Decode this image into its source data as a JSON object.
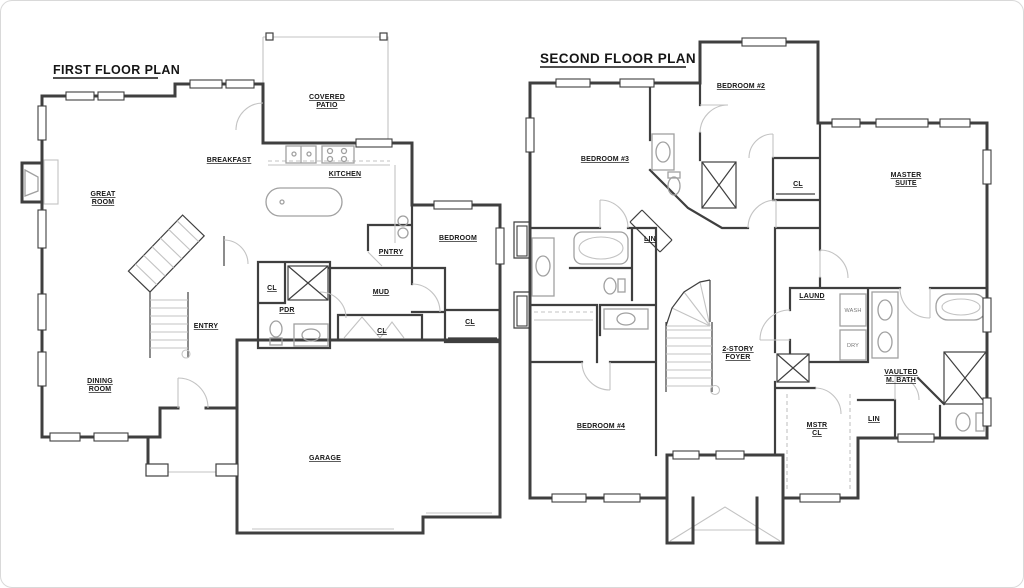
{
  "document": {
    "kind": "residential floor plan drawing"
  },
  "colors": {
    "background": "#ffffff",
    "wall": "#3f3f3f",
    "fixture": "#a0a0a0",
    "light": "#c3c3c3",
    "label": "#161616"
  },
  "first_floor": {
    "title": "FIRST FLOOR PLAN",
    "rooms": [
      {
        "name": "room-label-great-room",
        "lines": [
          "GREAT",
          "ROOM"
        ],
        "x": 103,
        "y": 196
      },
      {
        "name": "room-label-breakfast",
        "lines": [
          "BREAKFAST"
        ],
        "x": 229,
        "y": 162
      },
      {
        "name": "room-label-covered-patio",
        "lines": [
          "COVERED",
          "PATIO"
        ],
        "x": 327,
        "y": 99
      },
      {
        "name": "room-label-kitchen",
        "lines": [
          "KITCHEN"
        ],
        "x": 345,
        "y": 176
      },
      {
        "name": "room-label-pantry",
        "lines": [
          "PNTRY"
        ],
        "x": 391,
        "y": 254
      },
      {
        "name": "room-label-bedroom",
        "lines": [
          "BEDROOM"
        ],
        "x": 458,
        "y": 240
      },
      {
        "name": "room-label-entry",
        "lines": [
          "ENTRY"
        ],
        "x": 206,
        "y": 328
      },
      {
        "name": "room-label-mud",
        "lines": [
          "MUD"
        ],
        "x": 381,
        "y": 294
      },
      {
        "name": "room-label-powder-room",
        "lines": [
          "PDR"
        ],
        "x": 287,
        "y": 312
      },
      {
        "name": "room-label-closet-hall",
        "lines": [
          "CL"
        ],
        "x": 272,
        "y": 290
      },
      {
        "name": "room-label-closet-mud",
        "lines": [
          "CL"
        ],
        "x": 382,
        "y": 333
      },
      {
        "name": "room-label-closet-bedroom",
        "lines": [
          "CL"
        ],
        "x": 470,
        "y": 324
      },
      {
        "name": "room-label-dining-room",
        "lines": [
          "DINING",
          "ROOM"
        ],
        "x": 100,
        "y": 383
      },
      {
        "name": "room-label-garage",
        "lines": [
          "GARAGE"
        ],
        "x": 325,
        "y": 460
      }
    ]
  },
  "second_floor": {
    "title": "SECOND FLOOR PLAN",
    "rooms": [
      {
        "name": "room-label-bedroom-3",
        "lines": [
          "BEDROOM #3"
        ],
        "x": 605,
        "y": 161
      },
      {
        "name": "room-label-bedroom-2",
        "lines": [
          "BEDROOM #2"
        ],
        "x": 741,
        "y": 88
      },
      {
        "name": "room-label-master-suite",
        "lines": [
          "MASTER",
          "SUITE"
        ],
        "x": 906,
        "y": 177
      },
      {
        "name": "room-label-closet-bedroom-2",
        "lines": [
          "CL"
        ],
        "x": 798,
        "y": 186
      },
      {
        "name": "room-label-linen-hall",
        "lines": [
          "LIN"
        ],
        "x": 650,
        "y": 241
      },
      {
        "name": "room-label-laundry",
        "lines": [
          "LAUND"
        ],
        "x": 812,
        "y": 298
      },
      {
        "name": "appliance-label-washer",
        "lines": [
          "WASH"
        ],
        "x": 853,
        "y": 312,
        "small": true
      },
      {
        "name": "appliance-label-dryer",
        "lines": [
          "DRY"
        ],
        "x": 853,
        "y": 347,
        "small": true
      },
      {
        "name": "room-label-two-story-foyer",
        "lines": [
          "2-STORY",
          "FOYER"
        ],
        "x": 738,
        "y": 351
      },
      {
        "name": "room-label-master-closet",
        "lines": [
          "MSTR",
          "CL"
        ],
        "x": 817,
        "y": 427
      },
      {
        "name": "room-label-linen-master",
        "lines": [
          "LIN"
        ],
        "x": 874,
        "y": 421
      },
      {
        "name": "room-label-vaulted-master-bath",
        "lines": [
          "VAULTED",
          "M. BATH"
        ],
        "x": 901,
        "y": 374
      },
      {
        "name": "room-label-bedroom-4",
        "lines": [
          "BEDROOM #4"
        ],
        "x": 601,
        "y": 428
      }
    ]
  }
}
